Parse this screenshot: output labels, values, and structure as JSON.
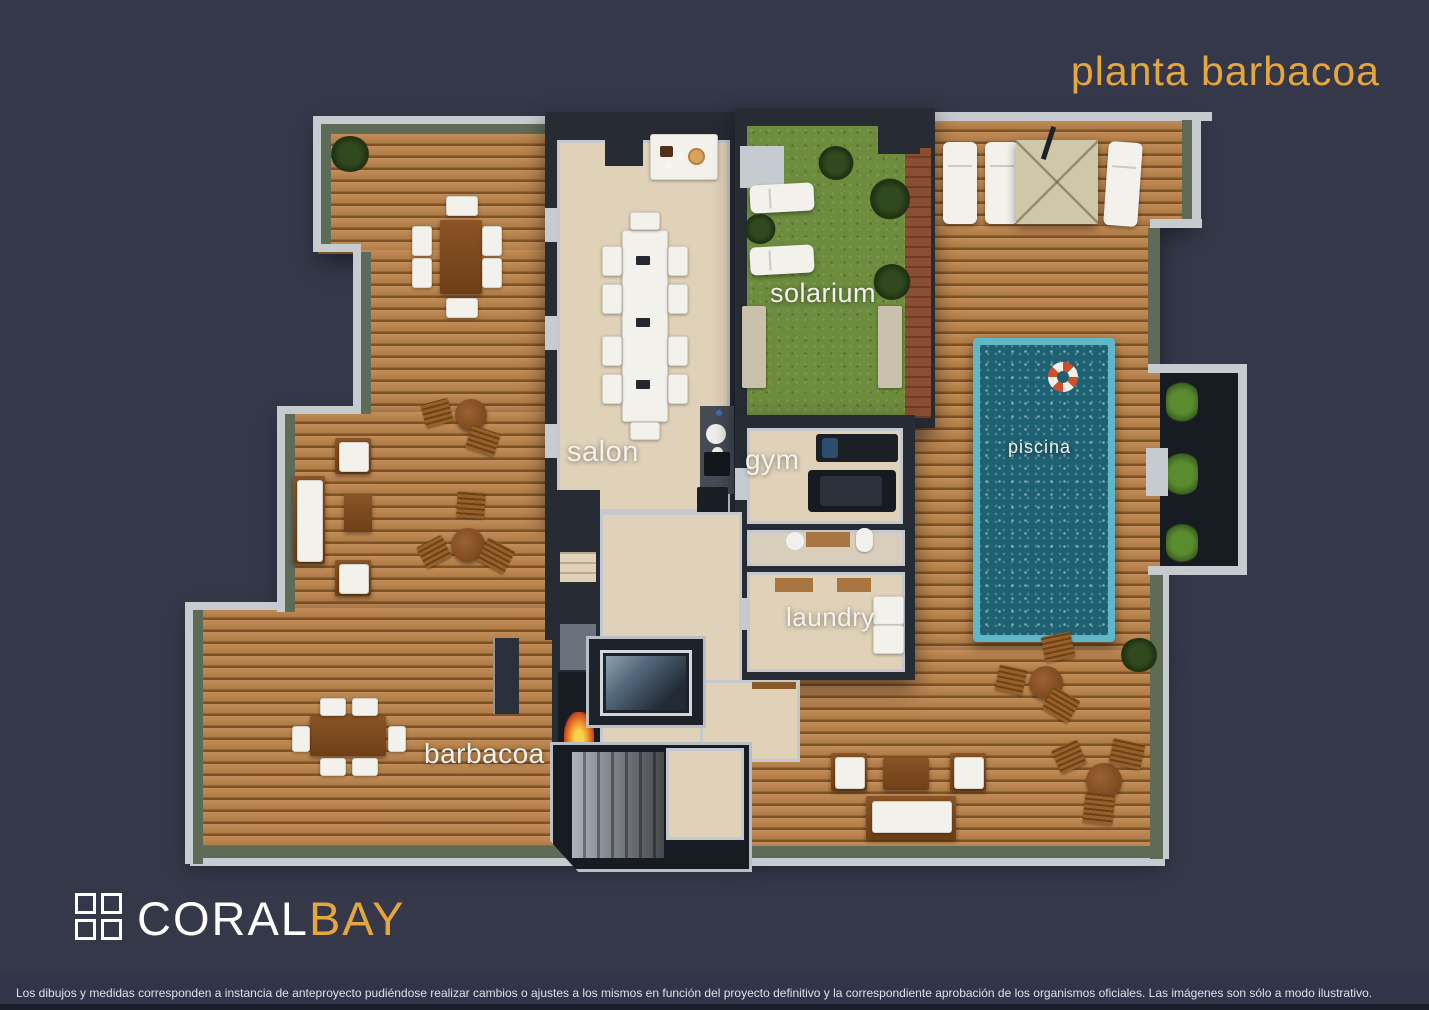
{
  "title": "planta barbacoa",
  "logo": {
    "coral": "CORAL",
    "bay": "BAY"
  },
  "rooms": {
    "solarium": "solarium",
    "salon": "salon",
    "gym": "gym",
    "piscina": "piscina",
    "laundry": "laundry",
    "barbacoa": "barbacoa"
  },
  "footer": {
    "disclaimer": "Los dibujos y medidas corresponden a instancia de anteproyecto pudiéndose realizar cambios o ajustes a los mismos en función del proyecto definitivo y la correspondiente aprobación de los organismos oficiales. Las imágenes son sólo a modo ilustrativo."
  },
  "palette": {
    "background": "#343849",
    "accent_orange": "#e5a63c",
    "wood_deck": "#b9824e",
    "grass": "#6d8c3e",
    "pool_water": "#1d6173",
    "pool_edge": "#5fb7c8",
    "wall": "#262b34",
    "wall_cap": "#c6cbd0",
    "parapet_green": "#5d6b57",
    "interior_floor": "#e0d2b8",
    "label_white": "#f3f2ee",
    "footer_line": "#1a1d2a"
  }
}
